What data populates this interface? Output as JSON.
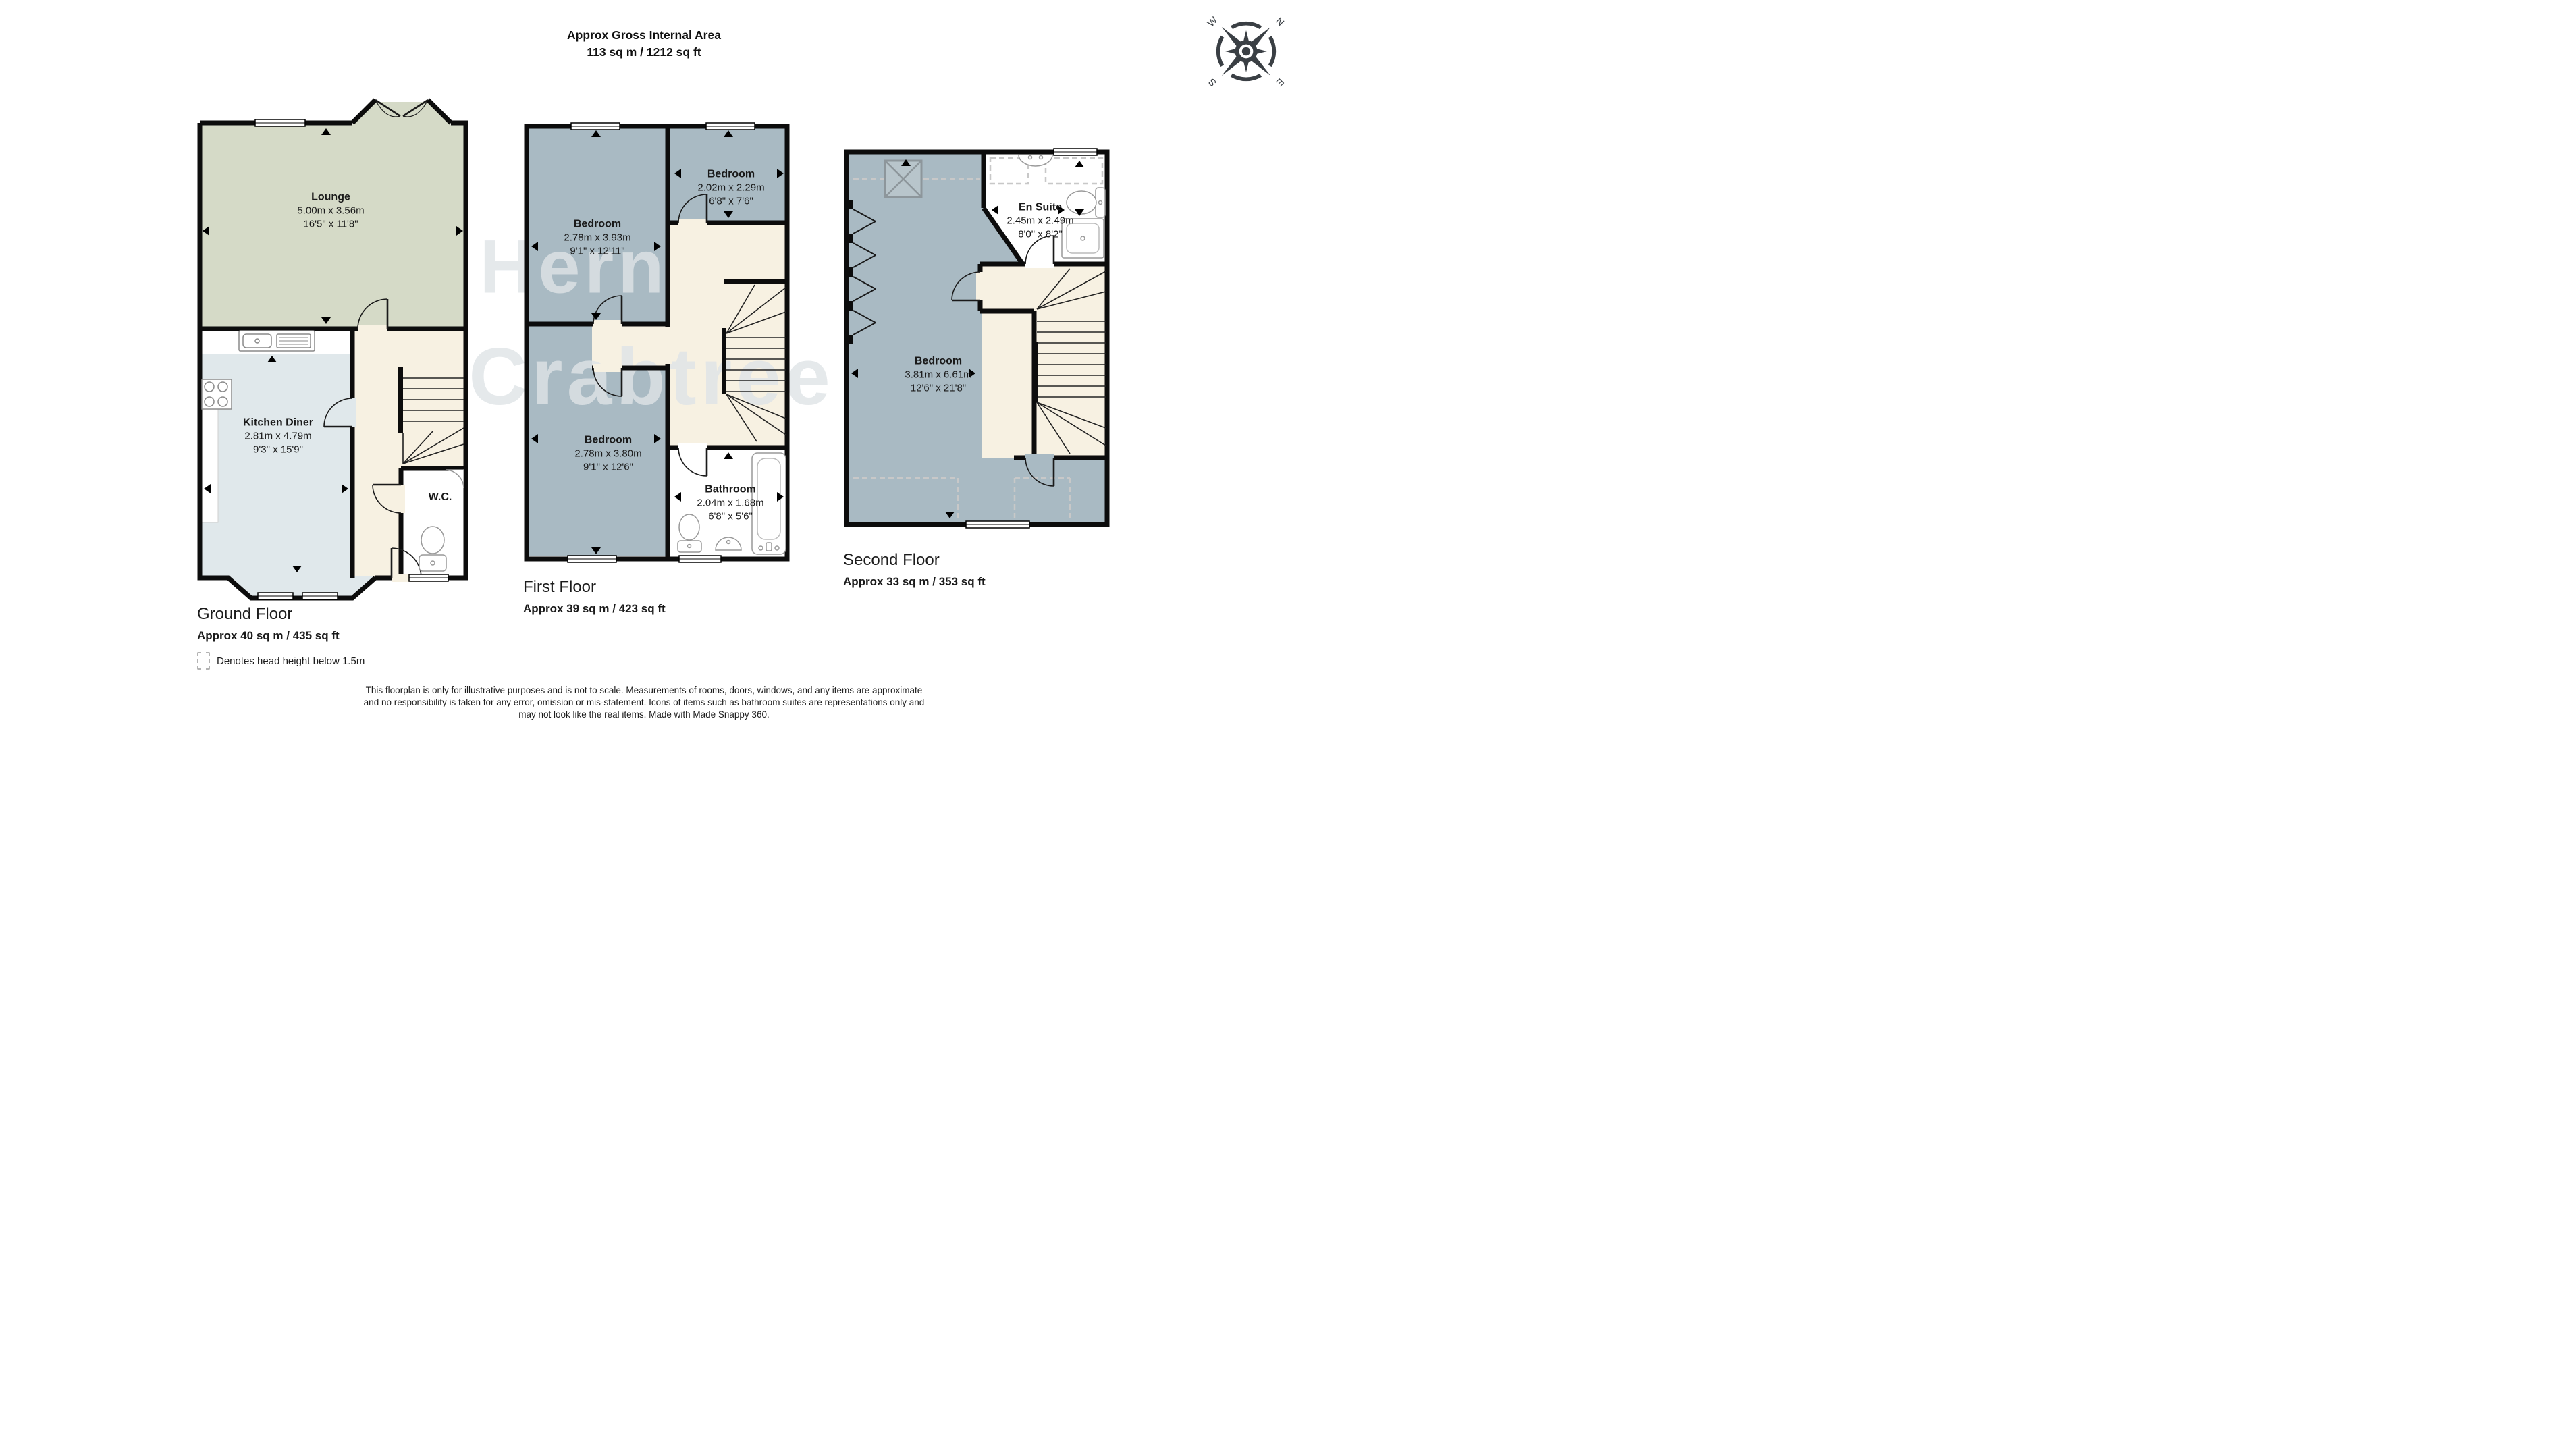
{
  "header": {
    "title_line1": "Approx Gross Internal Area",
    "title_line2": "113 sq m / 1212 sq ft"
  },
  "compass": {
    "north": "N",
    "east": "E",
    "south": "S",
    "west": "W"
  },
  "watermark": {
    "line1": "Hern",
    "line2": "Crabtree"
  },
  "floors": {
    "ground": {
      "title": "Ground Floor",
      "area": "Approx 40 sq m / 435 sq ft",
      "rooms": {
        "lounge": {
          "name": "Lounge",
          "metric": "5.00m x 3.56m",
          "imperial": "16'5\" x 11'8\""
        },
        "kitchen": {
          "name": "Kitchen Diner",
          "metric": "2.81m x 4.79m",
          "imperial": "9'3\" x 15'9\""
        },
        "wc": {
          "name": "W.C."
        }
      }
    },
    "first": {
      "title": "First Floor",
      "area": "Approx 39 sq m / 423 sq ft",
      "rooms": {
        "bedroom1": {
          "name": "Bedroom",
          "metric": "2.78m x 3.93m",
          "imperial": "9'1\" x 12'11\""
        },
        "bedroom2": {
          "name": "Bedroom",
          "metric": "2.02m x 2.29m",
          "imperial": "6'8\" x 7'6\""
        },
        "bedroom3": {
          "name": "Bedroom",
          "metric": "2.78m x 3.80m",
          "imperial": "9'1\" x 12'6\""
        },
        "bathroom": {
          "name": "Bathroom",
          "metric": "2.04m x 1.68m",
          "imperial": "6'8\" x 5'6\""
        }
      }
    },
    "second": {
      "title": "Second Floor",
      "area": "Approx 33 sq m / 353 sq ft",
      "rooms": {
        "bedroom": {
          "name": "Bedroom",
          "metric": "3.81m x 6.61m",
          "imperial": "12'6\" x 21'8\""
        },
        "ensuite": {
          "name": "En Suite",
          "metric": "2.45m x 2.49m",
          "imperial": "8'0\" x 8'2\""
        }
      }
    }
  },
  "legend": {
    "text": "Denotes head height below 1.5m"
  },
  "footer": {
    "line1": "This floorplan is only for illustrative purposes and is not to scale. Measurements of rooms, doors, windows, and any items are approximate",
    "line2": "and no responsibility is taken for any error, omission or mis-statement. Icons of items such as bathroom suites are representations only and",
    "line3": "may not look like the real items. Made with Made Snappy 360."
  },
  "colors": {
    "wall": "#0c0c0c",
    "lounge": "#d5dac7",
    "kitchen": "#e0e8eb",
    "bedroom": "#a9bac3",
    "hall": "#f7f1e2",
    "white_room": "#ffffff"
  }
}
